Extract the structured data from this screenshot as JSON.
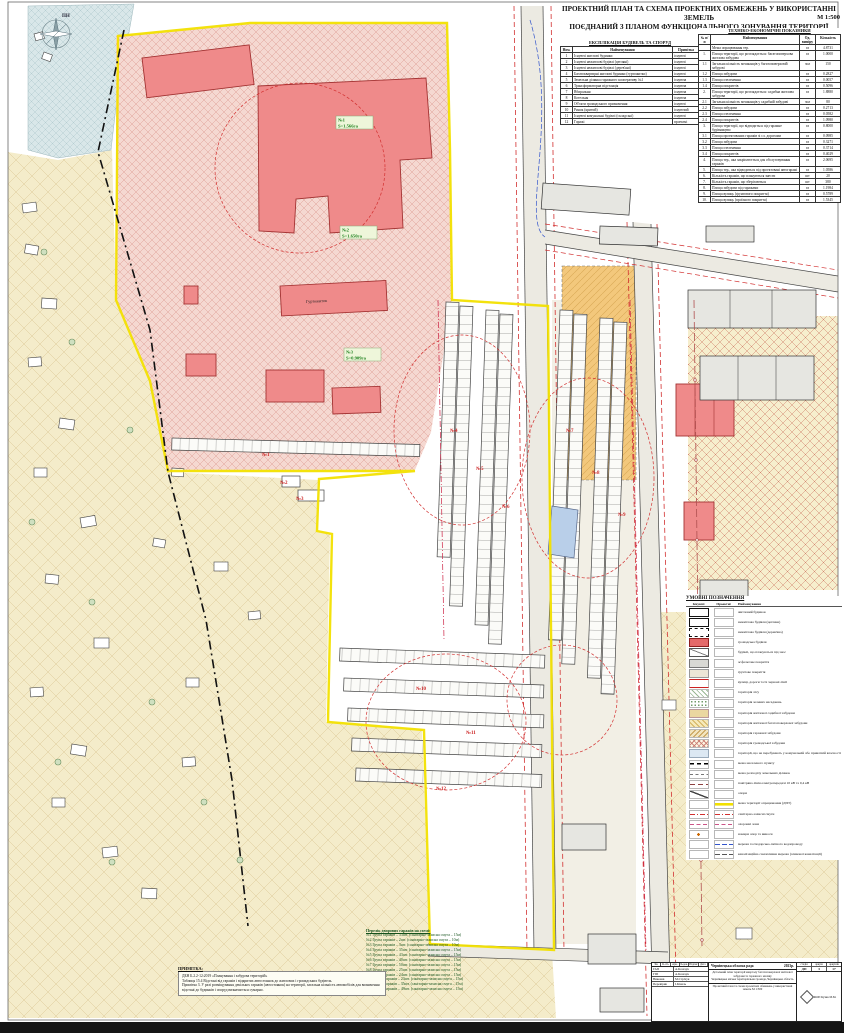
{
  "sheet": {
    "title_line1": "ПРОЕКТНИЙ ПЛАН ТА СХЕМА ПРОЕКТНИХ ОБМЕЖЕНЬ У ВИКОРИСТАННІ ЗЕМЕЛЬ",
    "title_line2": "ПОЄДНАНИЙ З ПЛАНОМ ФУНКЦІОНАЛЬНОГО ЗОНУВАННЯ ТЕРИТОРІЇ",
    "scale": "М 1:500"
  },
  "explication": {
    "title": "ЕКСПЛІКАЦІЯ БУДІВЕЛЬ ТА СПОРУД",
    "columns": [
      "Ном.",
      "Найменування",
      "Примітка"
    ],
    "rows": [
      [
        "1",
        "Існуючі житлові будинки",
        "існуючі"
      ],
      [
        "2",
        "Існуючі нежитлові будівлі (цегляні)",
        "існуючі"
      ],
      [
        "3",
        "Існуючі нежитлові будівлі (дерев'яні)",
        "існуючі"
      ],
      [
        "4",
        "Багатоквартирні житлові будинки (гуртожитки)",
        "існуючі"
      ],
      [
        "5",
        "Земельна ділянка гаражного кооперативу №1",
        "існуюча"
      ],
      [
        "6",
        "Трансформаторна підстанція",
        "існуюча"
      ],
      [
        "7",
        "Вбиральня",
        "існуюча"
      ],
      [
        "8",
        "Котельня",
        "існуюча"
      ],
      [
        "9",
        "Об'єкти громадського призначення",
        "існуючі"
      ],
      [
        "10",
        "Ринок (критий)",
        "існуючий"
      ],
      [
        "11",
        "Існуючі комунальні будівлі (складські)",
        "існуючі"
      ],
      [
        "12",
        "Гаражі",
        "проектні"
      ]
    ]
  },
  "indicators": {
    "title": "ТЕХНІКО-ЕКОНОМІЧНІ ПОКАЗНИКИ",
    "columns": [
      "№ п/п",
      "Найменування",
      "Од. виміру",
      "Кількість"
    ],
    "rows": [
      [
        "",
        "Межа опрацювання тер.",
        "га",
        "4.8731"
      ],
      [
        "1.",
        "Площа території, що розглядається: багатоповерхова житлова забудова",
        "га",
        "1.0000"
      ],
      [
        "1.1",
        "Загальна кількість мешканців у багатоповерховій забудові",
        "чол",
        "150"
      ],
      [
        "1.2",
        "Площа забудови",
        "га",
        "0.2827"
      ],
      [
        "1.3",
        "Площа озеленення",
        "га",
        "0.0057"
      ],
      [
        "1.4",
        "Площа покриттів",
        "га",
        "0.5096"
      ],
      [
        "2.",
        "Площа території, що розглядається: садибна житлова забудова",
        "га",
        "1.8880"
      ],
      [
        "2.1",
        "Загальна кількість мешканців у садибній забудові",
        "чол",
        "80"
      ],
      [
        "2.2",
        "Площа забудови",
        "га",
        "0.2713"
      ],
      [
        "2.3",
        "Площа озеленення",
        "га",
        "0.0582"
      ],
      [
        "2.4",
        "Площа покриттів",
        "га",
        "1.0980"
      ],
      [
        "3.",
        "Площа території, що відводиться під гаражне будівництво",
        "га",
        "0.8000"
      ],
      [
        "3.1",
        "Площа проектованих гаражів зі сл. дорогами",
        "га",
        "0.0985"
      ],
      [
        "3.2",
        "Площа забудови",
        "га",
        "0.3271"
      ],
      [
        "3.3",
        "Площа озеленення",
        "га",
        "0.3714"
      ],
      [
        "3.4",
        "Площа покриттів",
        "га",
        "0.4029"
      ],
      [
        "4.",
        "Площа тер., яка закріплюється для обслуговування гаражів",
        "га",
        "2.0695"
      ],
      [
        "5.",
        "Площа тер., яка відводиться під проектовані автогаражі",
        "га",
        "1.0586"
      ],
      [
        "6.",
        "Кількість гаражів, що плануються знести",
        "шт",
        "20"
      ],
      [
        "7.",
        "Кількість гаражів, що зберігаються",
        "шт",
        "380"
      ],
      [
        "8.",
        "Площа забудови під гаражами",
        "га",
        "1.1984"
      ],
      [
        "9.",
        "Площа вулиць (ґрунтового покриття)",
        "га",
        "0.5789"
      ],
      [
        "10.",
        "Площа вулиць (проїзного покриття)",
        "га",
        "1.5345"
      ]
    ]
  },
  "legend": {
    "title": "УМОВНІ ПОЗНАЧЕННЯ",
    "columns": [
      "Існуючі",
      "Проектні",
      "Найменування"
    ],
    "items": [
      {
        "ex": "res",
        "pr": "",
        "label": "житловий будинок"
      },
      {
        "ex": "brick",
        "pr": "",
        "label": "нежитлова будівля (цегляна)"
      },
      {
        "ex": "wood",
        "pr": "",
        "label": "нежитлова будівля (дерев'яна)"
      },
      {
        "ex": "public",
        "pr": "",
        "label": "громадська будівля"
      },
      {
        "ex": "demolish",
        "pr": "",
        "label": "будівлі, що плануються під знос"
      },
      {
        "ex": "asphalt",
        "pr": "",
        "label": "асфальтове покриття"
      },
      {
        "ex": "ground",
        "pr": "",
        "label": "ґрунтове покриття"
      },
      {
        "ex": "street",
        "pr": "",
        "label": "вулиці, дороги та їх червоні лінії"
      },
      {
        "ex": "forest",
        "pr": "",
        "label": "територія лісу"
      },
      {
        "ex": "green",
        "pr": "",
        "label": "територія зелених насаджень"
      },
      {
        "ex": "estate",
        "pr": "",
        "label": "територія житлової садибної забудови"
      },
      {
        "ex": "multi",
        "pr": "",
        "label": "територія житлової багатоповерхової забудови"
      },
      {
        "ex": "garage-terr",
        "pr": "",
        "label": "територія гаражної забудови"
      },
      {
        "ex": "public-terr",
        "pr": "",
        "label": "територія громадської забудови"
      },
      {
        "ex": "notowned",
        "pr": "",
        "label": "території, що не перебувають у комунальній або приватній власності"
      },
      {
        "ex": "bound-settl",
        "pr": "",
        "label": "межа населеного пункту"
      },
      {
        "ex": "parcel",
        "pr": "",
        "label": "межа розподілу земельних ділянок"
      },
      {
        "ex": "power",
        "pr": "",
        "label": "повітряна лінія електропередачі 10 кВ та 0,4 кВ"
      },
      {
        "ex": "poles",
        "pr": "",
        "label": "опори"
      },
      {
        "ex": "",
        "pr": "dpt",
        "label": "межа території опрацювання (ДПТ)"
      },
      {
        "ex": "sanitary",
        "pr": "sanitary",
        "label": "санітарно-захисні смуги"
      },
      {
        "ex": "protect",
        "pr": "protect",
        "label": "охоронні зони"
      },
      {
        "ex": "pole-num",
        "pr": "",
        "label": "номери опор та виноси"
      },
      {
        "ex": "",
        "pr": "water",
        "label": "мережа господарсько-питного водопроводу"
      },
      {
        "ex": "",
        "pr": "sewer",
        "label": "каналізаційна самопливна мережа (зливової каналізації)"
      }
    ]
  },
  "garage_list": {
    "title": "Перелік дворових гаражів на схемі:",
    "items": [
      "№1 Група гаражів – 33шт. (санітарно-захисна смуга – 15м)",
      "№2 Група гаражів – 2шт. (санітарно-захисна смуга – 10м)",
      "№3 Група гаражів – 3шт. (санітарно-захисна смуга – 10м)",
      "№4 Група гаражів – 35шт. (санітарно-захисна смуга – 15м)",
      "№5 Група гаражів – 43шт. (санітарно-захисна смуга – 15м)",
      "№6 Група гаражів – 40шт. (санітарно-захисна смуга – 15м)",
      "№7 Група гаражів – 50шт. (санітарно-захисна смуга – 15м)",
      "№8 Група гаражів – 25шт. (санітарно-захисна смуга – 15м)",
      "№9 Група гаражів – 24шт. (санітарно-захисна смуга – 15м)",
      "№10 Група гаражів – 23шт. (санітарно-захисна смуга – 15м)",
      "№11 Група гаражів – 35шт. (санітарно-захисна смуга – 15м)",
      "№12 Група гаражів – 49шт. (санітарно-захисна смуга – 15м)"
    ]
  },
  "note": {
    "title": "ПРИМІТКА:",
    "lines": [
      "ДБН Б.2.2-12:2019 «Планування і забудова територій»",
      "Таблиця 15.4 Відстані від гаражів і відкритих автостоянок до житлових і громадських будівель.",
      "Примітка 3. У разі розміщування декількох гаражів (автостоянок) на території, загальна кількість автомобілів для визначення відстані до будинків і споруд визначається сумарно."
    ]
  },
  "stamp": {
    "org": "Чернівецька обласна рада",
    "year": "2023р.",
    "project_line1": "Детальний план території кварталу багатоповерхової житлової забудови та гаражного масиву",
    "project_line2": "Чернівецька міська територіальна громада, Чернівецька область",
    "sheet_caption": "Проектний план та схема проектних обмежень у використанні земель М 1:500",
    "stage_headers": [
      "стадія",
      "аркуш",
      "аркушів"
    ],
    "stage_values": [
      "ДП",
      "3",
      "17"
    ],
    "sign_headers": [
      "Зм.",
      "К-сть",
      "Арк.",
      "№док.",
      "Підпис",
      "Дата"
    ],
    "roles": [
      [
        "ГАП",
        "А.Козачук"
      ],
      [
        "ГІП",
        "А.Козачук"
      ],
      [
        "Виконав",
        "М.Стрічук"
      ],
      [
        "Перевірив",
        "І.Кіналь"
      ]
    ],
    "firm": "ФОП Кузик М.М."
  },
  "map": {
    "compass_label": "ПН",
    "building_label": "Гуртожиток",
    "zones": [
      {
        "num": "№1",
        "area": "S=1.566га"
      },
      {
        "num": "№2",
        "area": "S=1.650га"
      },
      {
        "num": "№3",
        "area": "S=0.909га"
      }
    ],
    "garage_labels": [
      "№1",
      "№2",
      "№3",
      "№4",
      "№5",
      "№6",
      "№7",
      "№8",
      "№9",
      "№10",
      "№11",
      "№12"
    ]
  },
  "colors": {
    "dpt_boundary": "#f2e000",
    "sanitary_line": "#d23030",
    "zone_label": "#1b7f1b",
    "building_fill": "#ef8a8a"
  }
}
